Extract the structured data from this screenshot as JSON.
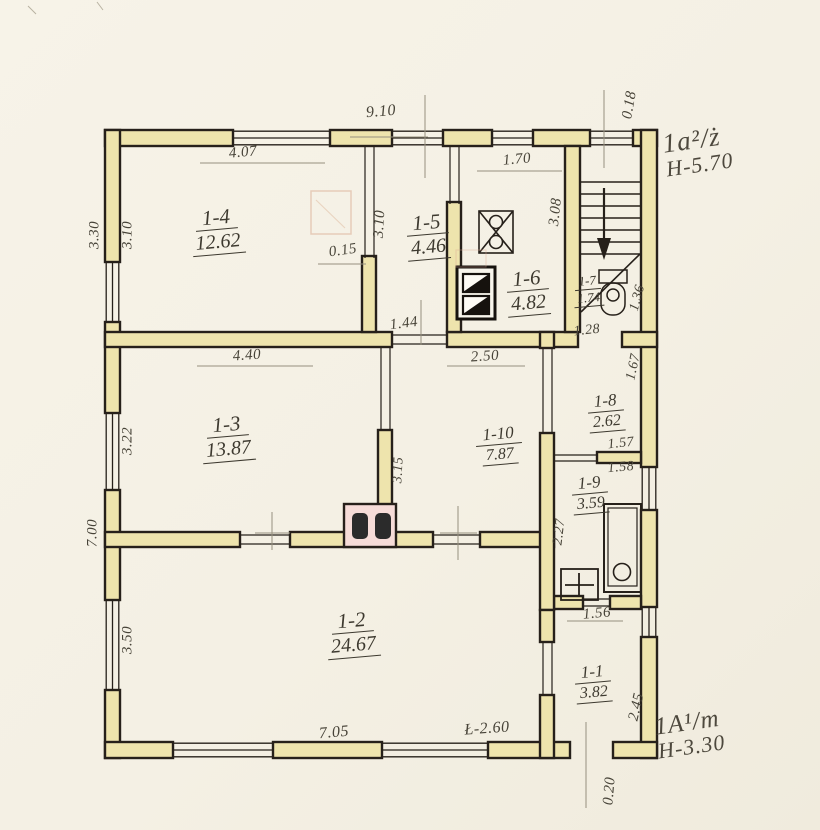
{
  "drawing": {
    "kind": "inventory floor plan"
  },
  "rooms": {
    "r14": {
      "id": "1-4",
      "area": "12.62"
    },
    "r15": {
      "id": "1-5",
      "area": "4.46"
    },
    "r16": {
      "id": "1-6",
      "area": "4.82"
    },
    "r17": {
      "id": "1-7",
      "area": "1.74"
    },
    "r13": {
      "id": "1-3",
      "area": "13.87"
    },
    "r110": {
      "id": "1-10",
      "area": "7.87"
    },
    "r18": {
      "id": "1-8",
      "area": "2.62"
    },
    "r19": {
      "id": "1-9",
      "area": "3.59"
    },
    "r12": {
      "id": "1-2",
      "area": "24.67"
    },
    "r11": {
      "id": "1-1",
      "area": "3.82"
    }
  },
  "dims": {
    "top_total": "9.10",
    "top_offset": "0.18",
    "w14_top": "4.07",
    "w15_top": "1.70",
    "left_out": "3.30",
    "left_in": "3.10",
    "part_310": "3.10",
    "wall_t": "0.15",
    "stair_h": "3.08",
    "door_144": "1.44",
    "stair_door": "1.28",
    "wc_w": "1.36",
    "w13_top": "4.40",
    "w110_top": "2.50",
    "r18_right": "1.67",
    "left_322": "3.22",
    "r18_157": "1.57",
    "r18_158": "1.58",
    "part_315": "3.15",
    "left_700": "7.00",
    "r19_227": "2.27",
    "left_350": "3.50",
    "r19_156": "1.56",
    "r11_245": "2.45",
    "bottom_705": "7.05",
    "bottom_260": "Ł-2.60",
    "bottom_020": "0.20"
  },
  "annotations": {
    "upper": {
      "code": "1a²/ż",
      "height": "H-5.70"
    },
    "lower": {
      "code": "1A¹/m",
      "height": "H-3.30"
    }
  },
  "fixtures": [
    "gas-stove",
    "solid-fuel-range",
    "tile-stove",
    "bathtub",
    "washbasin",
    "toilet",
    "stairs-down"
  ],
  "colors": {
    "wall_fill": "#eee4ad",
    "ink": "#26201a",
    "pencil": "#96907f",
    "stove_pink": "#f6dcd8"
  }
}
